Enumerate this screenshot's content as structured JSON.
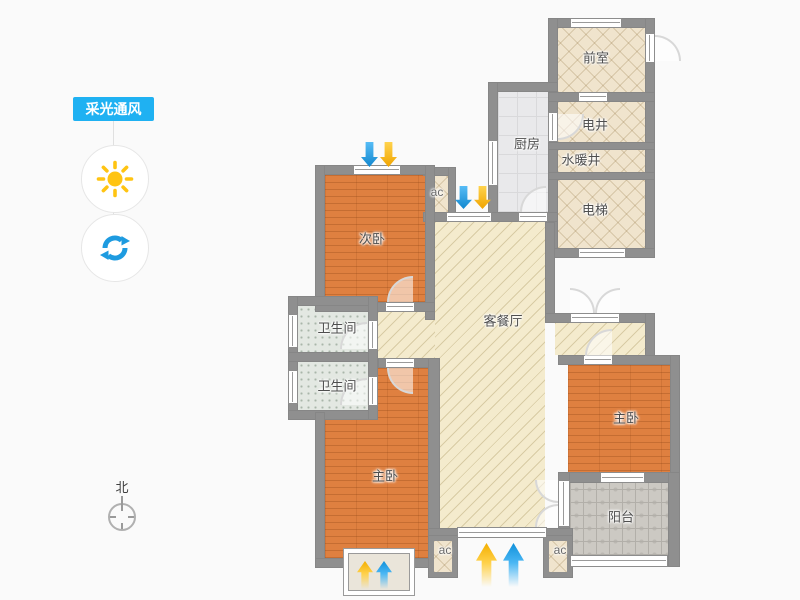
{
  "panel": {
    "badge_label": "采光通风",
    "sun_button": "daylight-toggle",
    "refresh_button": "ventilation-toggle"
  },
  "compass": {
    "north_label": "北"
  },
  "rooms": {
    "qianshi": "前室",
    "dianjing": "电井",
    "shuinuanjing": "水暖井",
    "dianti": "电梯",
    "chufang": "厨房",
    "ciwo": "次卧",
    "kecanting": "客餐厅",
    "weishengjian1": "卫生间",
    "weishengjian2": "卫生间",
    "zhuwo_left": "主卧",
    "zhuwo_right": "主卧",
    "yangtai": "阳台",
    "ac1": "ac",
    "ac2": "ac",
    "ac3": "ac"
  },
  "colors": {
    "badge_bg": "#1fb1f2",
    "wall": "#8f8f8f",
    "bedroom_floor": "#df8040",
    "living_floor": "#f4ebcd",
    "kitchen_floor": "#e9e9eb",
    "bath_floor": "#e3e8e2",
    "balcony_floor": "#ccc9c3",
    "arrow_blue": "#2aa6ea",
    "arrow_yellow": "#ffc612",
    "sun_icon": "#ffc412",
    "refresh_icon": "#1e9be0"
  }
}
